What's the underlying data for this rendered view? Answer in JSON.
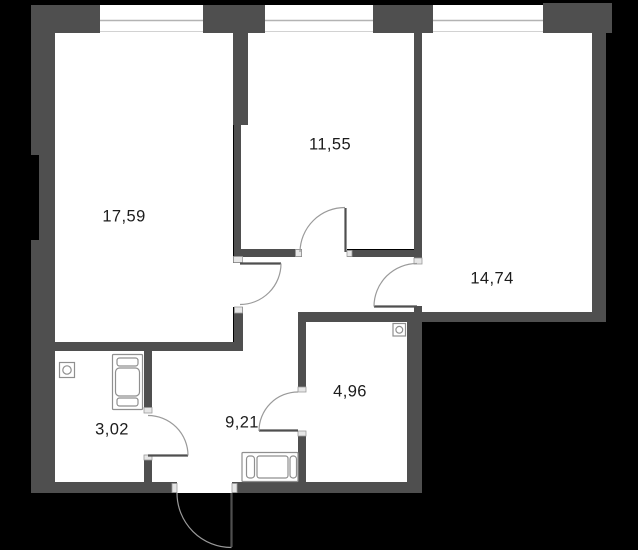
{
  "plan": {
    "colors": {
      "background": "#000000",
      "wall": "#4f4f4f",
      "floor": "#ffffff",
      "door_arc": "#9a9a9a",
      "cap": "#e6e6e6",
      "label": "#1c1c1c"
    },
    "rooms": [
      {
        "area": "17,59"
      },
      {
        "area": "11,55"
      },
      {
        "area": "14,74"
      },
      {
        "area": "4,96"
      },
      {
        "area": "9,21"
      },
      {
        "area": "3,02"
      }
    ],
    "icons": [
      {
        "name": "ventilation-icon"
      },
      {
        "name": "ventilation-icon"
      },
      {
        "name": "appliance-icon"
      },
      {
        "name": "cabinet-icon"
      }
    ]
  }
}
